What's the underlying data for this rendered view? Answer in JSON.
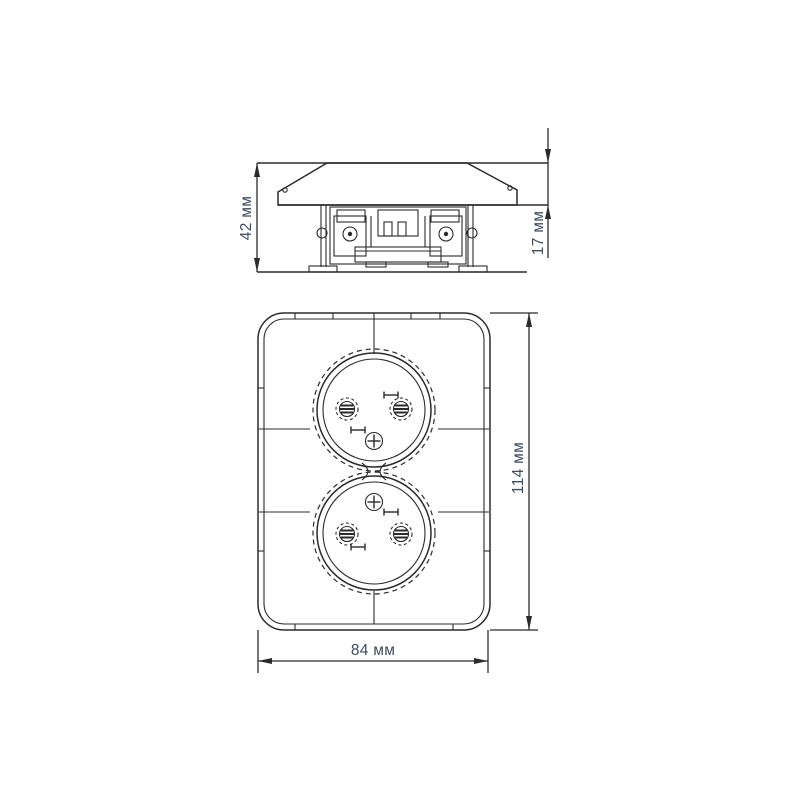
{
  "drawing": {
    "background": "#ffffff",
    "line_color": "#2b2b2b",
    "dimension_text_color": "#3e4c60",
    "dimensions": {
      "overall_depth": {
        "label": "42 мм"
      },
      "cover_projection": {
        "label": "17 мм"
      },
      "plate_height": {
        "label": "114 мм"
      },
      "plate_width": {
        "label": "84 мм"
      }
    }
  }
}
